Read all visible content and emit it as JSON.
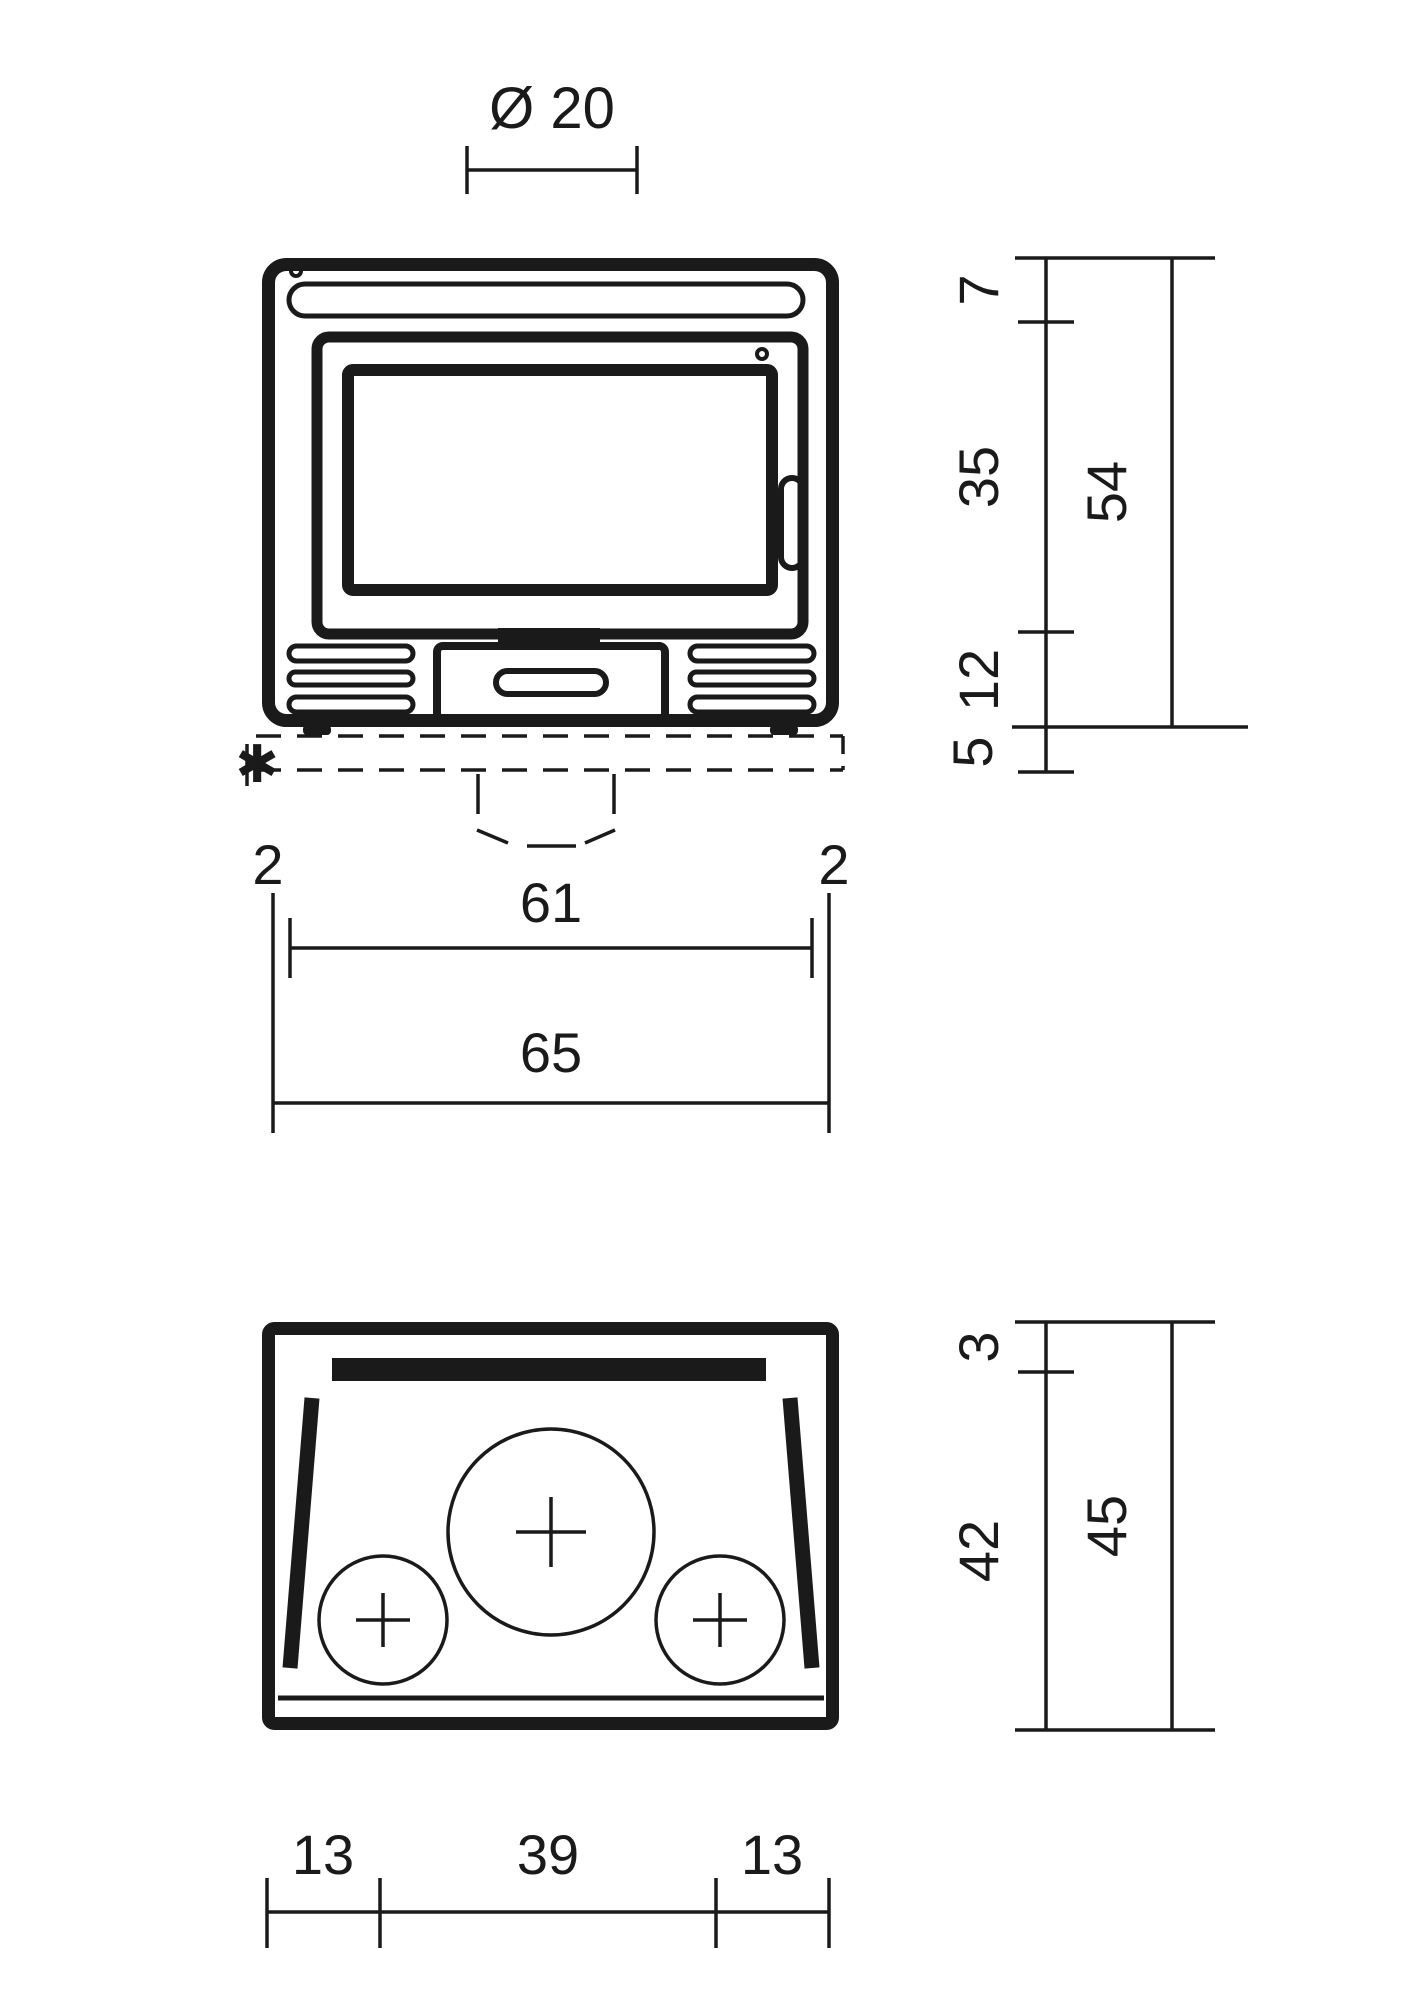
{
  "drawing": {
    "front_view": {
      "flue_diameter_label": "Ø 20",
      "height_top_label": "7",
      "height_door_label": "35",
      "height_base_label": "12",
      "height_plinth_label": "5",
      "height_overall_label": "54",
      "width_left_offset_label": "2",
      "width_inner_label": "61",
      "width_right_offset_label": "2",
      "width_overall_label": "65",
      "footnote_marker": "✱"
    },
    "top_view": {
      "depth_back_label": "3",
      "depth_inner_label": "42",
      "depth_overall_label": "45",
      "width_left_label": "13",
      "width_center_label": "39",
      "width_right_label": "13"
    },
    "colors": {
      "line": "#1a1a1a",
      "marker": "#e30613",
      "background": "#ffffff"
    }
  }
}
